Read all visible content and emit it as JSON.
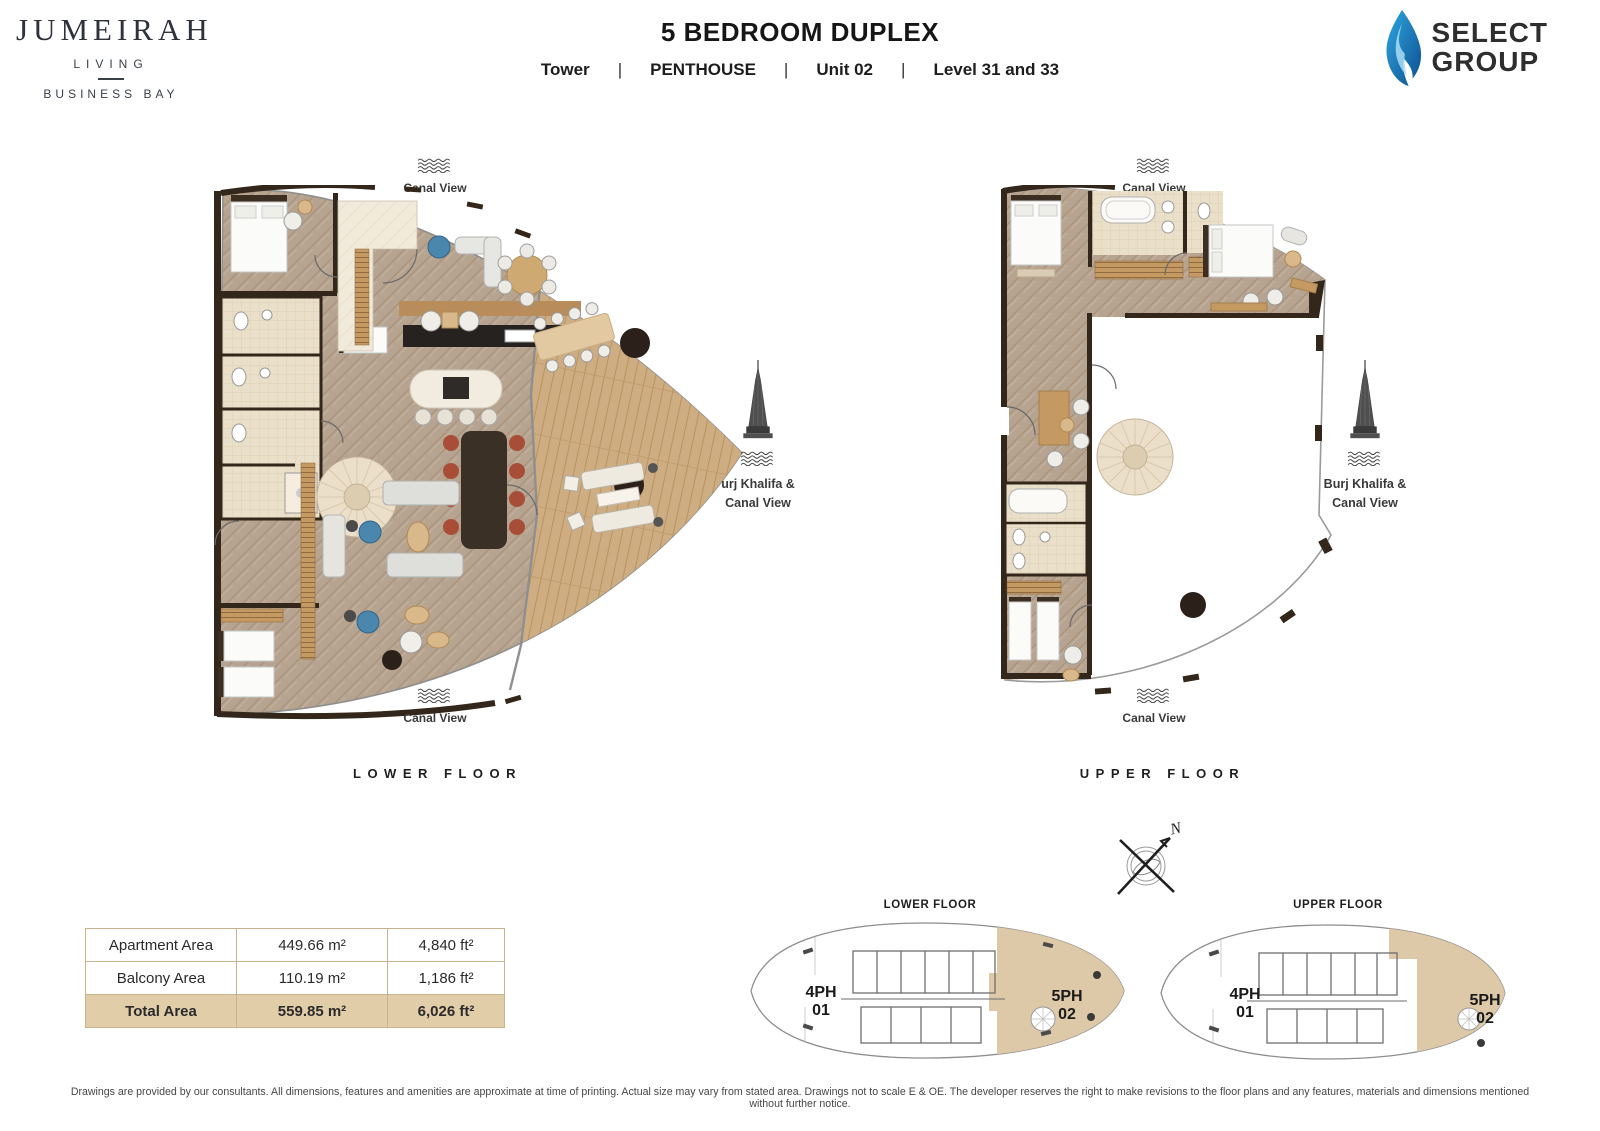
{
  "header": {
    "brand": {
      "name": "JUMEIRAH",
      "sub": "LIVING",
      "location": "BUSINESS BAY"
    },
    "title": "5 BEDROOM DUPLEX",
    "separator": "|",
    "subtitle_parts": [
      "Tower",
      "PENTHOUSE",
      "Unit 02",
      "Level 31 and 33"
    ],
    "developer": {
      "line1": "SELECT",
      "line2": "GROUP"
    }
  },
  "plans": {
    "lower": {
      "caption": "LOWER FLOOR",
      "canal_view_top": "Canal View",
      "canal_view_bottom": "Canal View",
      "burj_line1": "urj Khalifa &",
      "burj_line2": "Canal View"
    },
    "upper": {
      "caption": "UPPER FLOOR",
      "canal_view_top": "Canal View",
      "canal_view_bottom": "Canal View",
      "burj_line1": "Burj Khalifa &",
      "burj_line2": "Canal View"
    }
  },
  "compass": {
    "north": "N"
  },
  "key_plans": {
    "lower": {
      "caption": "LOWER FLOOR",
      "unit_left_1": "4PH",
      "unit_left_2": "01",
      "unit_right_1": "5PH",
      "unit_right_2": "02"
    },
    "upper": {
      "caption": "UPPER FLOOR",
      "unit_left_1": "4PH",
      "unit_left_2": "01",
      "unit_right_1": "5PH",
      "unit_right_2": "02"
    }
  },
  "area_table": {
    "rows": [
      {
        "label": "Apartment Area",
        "metric": "449.66 m²",
        "imperial": "4,840 ft²"
      },
      {
        "label": "Balcony Area",
        "metric": "110.19 m²",
        "imperial": "1,186 ft²"
      },
      {
        "label": "Total Area",
        "metric": "559.85 m²",
        "imperial": "6,026 ft²"
      }
    ]
  },
  "footer": {
    "disclaimer": "Drawings are provided by our consultants. All dimensions, features and amenities are approximate at time of printing.  Actual size may vary from stated area. Drawings not to scale E & OE. The developer reserves the right to make revisions to the floor plans and any features, materials and dimensions mentioned without further notice."
  },
  "colors": {
    "highlight_tan": "#DDC8A8",
    "table_total_bg": "#E2CDA9",
    "wall_brown": "#33261A",
    "floor_herringbone": "#B7A490",
    "balcony_wood": "#CFAD82",
    "flame_blue_dark": "#0D4E8F",
    "flame_blue_light": "#2FA8E1",
    "text_dark": "#2B2B2B"
  }
}
